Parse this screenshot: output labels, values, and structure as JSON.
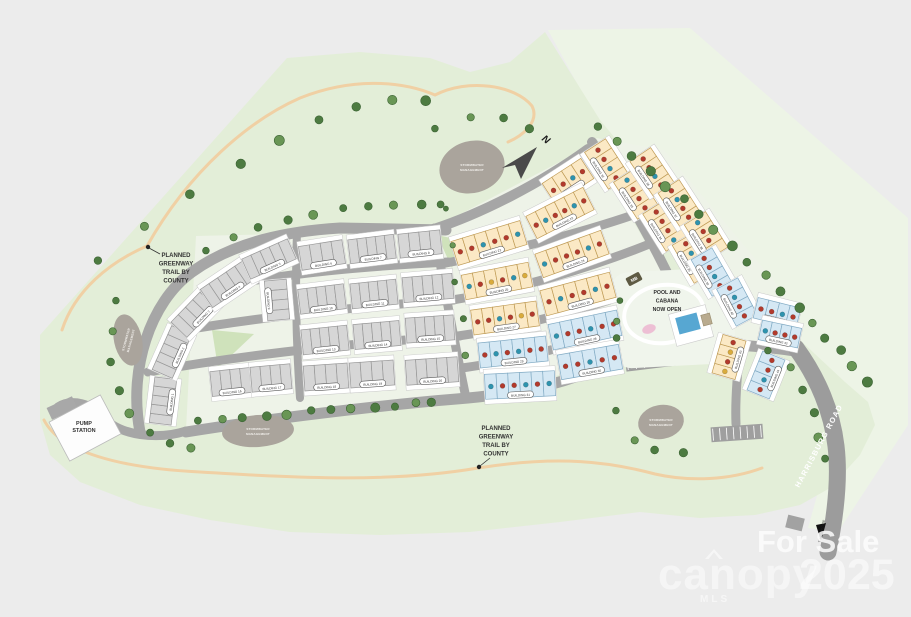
{
  "labels": {
    "greenway_note_lines": [
      "PLANNED",
      "GREENWAY",
      "TRAIL BY",
      "COUNTY"
    ],
    "pump_station_lines": [
      "PUMP",
      "STATION"
    ],
    "pool_lines": [
      "POOL AND",
      "CABANA",
      "NOW OPEN"
    ],
    "stormwater_lines": [
      "STORMWATER",
      "MANAGEMENT"
    ],
    "harrisburg_road": "HARRISBURG ROAD",
    "to_arrow": "TO CHARLOTTE",
    "mailbox": "MB",
    "north": "N",
    "building_prefix": "BUILDING"
  },
  "watermark": {
    "line1": "For Sale",
    "brand": "canopy",
    "brand_sub": "MLS",
    "year": "2025"
  },
  "scene": {
    "palette": {
      "bg": "#ececec",
      "site": "#e3eed8",
      "pale": "#edf4e6",
      "pad": "#eef3e8",
      "park": "#cfe2bb",
      "road": "#a6a6a6",
      "harris": "#9c9c9c",
      "trail": "#f0d0a4",
      "tree": "#4d7b41",
      "tree2": "#699655",
      "treeStroke": "#3c6334",
      "pond": "#aaa49c",
      "pondText": "#f4f2ee",
      "padStroke": "#c9c9c9",
      "gFill": "#d6d6d6",
      "gStroke": "#979797",
      "cFill": "#fbe9c5",
      "cStroke": "#bf9b55",
      "bFill": "#d5e8f4",
      "bStroke": "#82abc4",
      "dotR": "#b23a2c",
      "dotT": "#2e93ae",
      "dotY": "#d9ab3c",
      "ink": "#333333",
      "pillStroke": "#5a5a5a",
      "arrow": "#4a4a4a"
    },
    "greens": [
      {
        "d": "M548,30 L690,28 L908,218 L908,425 L838,532 L808,528 L845,395 L800,342 L700,236 L598,122 Z",
        "f": "#edf4e6"
      },
      {
        "d": "M287,58 L360,52 L430,58 L470,72 L510,62 L545,32 L600,120 L650,180 L700,235 L750,290 L800,340 L845,382 L868,402 L875,425 L860,455 L830,488 L800,505 L755,515 L700,518 L640,512 L560,522 L470,532 L380,535 L290,532 L210,520 L140,505 L80,482 L50,455 L40,420 L40,335 Z",
        "f": "#e3eed8"
      },
      {
        "d": "M196,236 L448,230 L468,400 L186,430 Z",
        "f": "#eef3e8"
      },
      {
        "d": "M434,228 L590,146 L690,320 L620,360 L466,398 Z",
        "f": "#eef3e8"
      },
      {
        "d": "M596,138 L664,150 L790,300 L800,350 L735,340 Z",
        "f": "#eef3e8"
      },
      {
        "d": "M212,330 L254,334 L218,368 Z",
        "f": "#cfe2bb"
      },
      {
        "d": "M437,235 L460,240 L452,268 Z",
        "f": "#cfe2bb"
      }
    ],
    "trails": [
      "M62,330 C75,290 110,262 147,246 C190,170 250,120 300,98 C350,78 400,80 435,95 C468,78 515,85 532,106 C540,122 522,136 508,142",
      "M44,420 C60,452 120,468 200,472 C300,478 390,483 478,468 C560,455 610,462 655,474 C690,482 730,480 762,468"
    ],
    "roads": [
      {
        "d": "M140,432 C128,370 150,302 192,272 C235,241 290,231 340,228 L446,230",
        "w": 11
      },
      {
        "d": "M186,432 C260,420 380,405 468,398 C530,392 570,382 612,362",
        "w": 11
      },
      {
        "d": "M434,229 C480,214 540,184 588,149",
        "w": 10
      },
      {
        "d": "M592,142 C630,200 662,258 688,318",
        "w": 10
      },
      {
        "d": "M446,263 C505,252 575,235 636,214",
        "w": 9
      },
      {
        "d": "M452,300 C515,290 590,268 652,243",
        "w": 9
      },
      {
        "d": "M458,336 C515,328 575,312 640,290",
        "w": 9
      },
      {
        "d": "M462,368 C520,360 575,345 622,326",
        "w": 9
      },
      {
        "d": "M434,228 C444,286 454,340 466,398",
        "w": 9
      },
      {
        "d": "M297,232 C295,290 296,340 300,398",
        "w": 8
      },
      {
        "d": "M201,290 C290,272 370,266 448,262",
        "w": 9
      },
      {
        "d": "M179,331 C280,314 380,305 454,300",
        "w": 9
      },
      {
        "d": "M148,372 C260,352 380,341 460,336",
        "w": 9
      },
      {
        "d": "M612,362 C648,352 686,344 722,344 C756,346 778,348 800,352",
        "w": 11
      },
      {
        "d": "M688,318 C696,332 706,340 718,344",
        "w": 10
      },
      {
        "d": "M635,290 C626,312 621,334 620,356",
        "w": 9
      },
      {
        "d": "M740,350 C737,376 735,400 736,424",
        "w": 9
      },
      {
        "d": "M186,431 C158,440 120,436 103,417 C92,404 72,398 58,407",
        "w": 9
      },
      {
        "d": "M796,348 C818,378 832,412 836,446 C840,480 835,518 828,552",
        "w": 17,
        "c": "#9c9c9c"
      }
    ],
    "parking": [
      {
        "x": 664,
        "y": 357,
        "w": 78,
        "h": 20,
        "a": -7,
        "n": 9
      },
      {
        "x": 737,
        "y": 433,
        "w": 52,
        "h": 15,
        "a": -4,
        "n": 7
      }
    ],
    "ponds": [
      {
        "x": 472,
        "y": 167,
        "rx": 33,
        "ry": 26,
        "a": -15,
        "tr": 0
      },
      {
        "x": 128,
        "y": 340,
        "rx": 14,
        "ry": 26,
        "a": -12,
        "tr": -75
      },
      {
        "x": 258,
        "y": 431,
        "rx": 36,
        "ry": 16,
        "a": -4,
        "tr": 0
      },
      {
        "x": 661,
        "y": 422,
        "rx": 23,
        "ry": 17,
        "a": -10,
        "tr": 0
      }
    ],
    "tree_strips": [
      {
        "p": [
          [
            100,
            262
          ],
          [
            150,
            222
          ],
          [
            205,
            185
          ],
          [
            260,
            150
          ],
          [
            300,
            128
          ],
          [
            345,
            110
          ],
          [
            390,
            100
          ],
          [
            425,
            100
          ]
        ],
        "n": 9,
        "r": 4.5
      },
      {
        "p": [
          [
            437,
            130
          ],
          [
            470,
            118
          ],
          [
            505,
            118
          ],
          [
            528,
            128
          ]
        ],
        "n": 4,
        "r": 4
      },
      {
        "p": [
          [
            208,
            252
          ],
          [
            240,
            234
          ],
          [
            275,
            222
          ],
          [
            310,
            214
          ],
          [
            345,
            209
          ],
          [
            380,
            206
          ],
          [
            415,
            204
          ],
          [
            442,
            203
          ]
        ],
        "n": 10,
        "r": 4
      },
      {
        "p": [
          [
            600,
            128
          ],
          [
            640,
            162
          ],
          [
            680,
            198
          ],
          [
            720,
            234
          ],
          [
            760,
            272
          ],
          [
            800,
            310
          ],
          [
            835,
            345
          ],
          [
            866,
            382
          ]
        ],
        "n": 18,
        "r": 4.5
      },
      {
        "p": [
          [
            200,
            422
          ],
          [
            240,
            418
          ],
          [
            280,
            414
          ],
          [
            320,
            411
          ],
          [
            360,
            408
          ],
          [
            400,
            405
          ],
          [
            432,
            403
          ]
        ],
        "n": 12,
        "r": 4.2
      },
      {
        "p": [
          [
            118,
            302
          ],
          [
            112,
            332
          ],
          [
            112,
            362
          ],
          [
            118,
            390
          ],
          [
            130,
            412
          ],
          [
            148,
            434
          ],
          [
            170,
            444
          ],
          [
            193,
            448
          ]
        ],
        "n": 8,
        "r": 4
      },
      {
        "p": [
          [
            770,
            352
          ],
          [
            790,
            368
          ],
          [
            804,
            390
          ],
          [
            813,
            412
          ],
          [
            819,
            436
          ],
          [
            823,
            460
          ]
        ],
        "n": 6,
        "r": 4
      },
      {
        "p": [
          [
            618,
            412
          ],
          [
            634,
            441
          ],
          [
            656,
            450
          ],
          [
            682,
            452
          ]
        ],
        "n": 4,
        "r": 4
      },
      {
        "p": [
          [
            622,
            302
          ],
          [
            616,
            322
          ],
          [
            618,
            338
          ]
        ],
        "n": 3,
        "r": 3.5
      },
      {
        "p": [
          [
            448,
            210
          ],
          [
            452,
            246
          ],
          [
            456,
            282
          ],
          [
            462,
            318
          ],
          [
            466,
            354
          ]
        ],
        "n": 5,
        "r": 3
      }
    ],
    "buildings": [
      [
        163,
        401,
        46,
        22,
        -83,
        "g",
        5,
        ""
      ],
      [
        172,
        352,
        48,
        22,
        -66,
        "g",
        5,
        ""
      ],
      [
        197,
        311,
        52,
        22,
        -46,
        "g",
        5,
        ""
      ],
      [
        228,
        284,
        52,
        22,
        -34,
        "g",
        5,
        ""
      ],
      [
        269,
        259,
        50,
        22,
        -24,
        "g",
        5,
        ""
      ],
      [
        322,
        255,
        44,
        24,
        -9,
        "g",
        4,
        ""
      ],
      [
        372,
        249,
        46,
        24,
        -7,
        "g",
        5,
        ""
      ],
      [
        420,
        244,
        42,
        24,
        -6,
        "g",
        4,
        ""
      ],
      [
        277,
        300,
        40,
        22,
        85,
        "g",
        4,
        ""
      ],
      [
        322,
        299,
        46,
        25,
        -7,
        "g",
        5,
        ""
      ],
      [
        374,
        294,
        46,
        25,
        -6,
        "g",
        5,
        ""
      ],
      [
        428,
        288,
        50,
        25,
        -5,
        "g",
        5,
        ""
      ],
      [
        325,
        340,
        46,
        25,
        -6,
        "g",
        5,
        ""
      ],
      [
        377,
        335,
        46,
        25,
        -5,
        "g",
        5,
        ""
      ],
      [
        430,
        329,
        48,
        25,
        -4,
        "g",
        5,
        ""
      ],
      [
        231,
        382,
        40,
        25,
        -6,
        "g",
        4,
        ""
      ],
      [
        271,
        378,
        40,
        25,
        -5,
        "g",
        4,
        ""
      ],
      [
        326,
        377,
        44,
        25,
        -4,
        "g",
        4,
        ""
      ],
      [
        372,
        374,
        44,
        25,
        -4,
        "g",
        4,
        ""
      ],
      [
        432,
        371,
        52,
        25,
        -4,
        "g",
        5,
        ""
      ],
      [
        568,
        181,
        46,
        24,
        -33,
        "c",
        4,
        "rrtr"
      ],
      [
        560,
        213,
        64,
        25,
        -27,
        "c",
        6,
        "rtrrtr"
      ],
      [
        489,
        243,
        72,
        25,
        -17,
        "c",
        6,
        "rrtrrt"
      ],
      [
        572,
        254,
        70,
        25,
        -20,
        "c",
        6,
        "trrrtr"
      ],
      [
        497,
        281,
        68,
        25,
        -11,
        "c",
        6,
        "tryrty"
      ],
      [
        578,
        294,
        72,
        26,
        -15,
        "c",
        6,
        "rtrrtr"
      ],
      [
        505,
        318,
        66,
        25,
        -8,
        "c",
        6,
        "rrtryr"
      ],
      [
        585,
        330,
        70,
        26,
        -12,
        "b",
        6,
        "trrtrr"
      ],
      [
        513,
        352,
        68,
        25,
        -6,
        "b",
        6,
        "rtrtrr"
      ],
      [
        590,
        362,
        62,
        25,
        -10,
        "b",
        5,
        "rrtrr"
      ],
      [
        520,
        385,
        70,
        25,
        -3,
        "b",
        6,
        "trrtrt"
      ],
      [
        607,
        164,
        44,
        25,
        57,
        "c",
        4,
        "rrtr"
      ],
      [
        636,
        194,
        44,
        25,
        57,
        "c",
        4,
        "trrr"
      ],
      [
        665,
        226,
        44,
        25,
        58,
        "c",
        4,
        "rrrt"
      ],
      [
        694,
        258,
        44,
        25,
        60,
        "c",
        4,
        "rtrr"
      ],
      [
        652,
        172,
        42,
        25,
        56,
        "c",
        4,
        "rrtr"
      ],
      [
        680,
        204,
        42,
        25,
        57,
        "c",
        4,
        "rtrr"
      ],
      [
        706,
        236,
        42,
        25,
        58,
        "c",
        4,
        "trrr"
      ],
      [
        712,
        272,
        42,
        24,
        60,
        "b",
        4,
        "rrtr"
      ],
      [
        737,
        302,
        42,
        24,
        62,
        "b",
        4,
        "rtrr"
      ],
      [
        777,
        313,
        44,
        21,
        14,
        "b",
        4,
        "rrtr"
      ],
      [
        780,
        334,
        40,
        20,
        12,
        "b",
        4,
        "trrr"
      ],
      [
        729,
        357,
        40,
        24,
        -74,
        "c",
        4,
        "yryr"
      ],
      [
        766,
        375,
        42,
        24,
        -68,
        "b",
        4,
        "rtrr"
      ]
    ],
    "pool": {
      "pad": {
        "x": 612,
        "y": 270,
        "w": 122,
        "h": 96,
        "r": 18,
        "a": -3
      },
      "loop": {
        "x": 664,
        "y": 314,
        "rx": 40,
        "ry": 29,
        "a": -8
      },
      "deck": {
        "x": 672,
        "y": 309,
        "w": 38,
        "h": 33,
        "a": -15
      },
      "water": {
        "x": 677,
        "y": 315,
        "w": 22,
        "h": 17,
        "a": -15
      },
      "cabana": {
        "x": 702,
        "y": 314,
        "w": 9,
        "h": 11,
        "a": -15
      },
      "playground": {
        "x": 649,
        "y": 329,
        "rx": 7,
        "ry": 4.5,
        "a": -20
      },
      "text": {
        "x": 667,
        "y": 294,
        "lh": 8.5
      }
    },
    "mailbox": {
      "x": 634,
      "y": 279,
      "w": 15,
      "h": 9,
      "a": -28
    },
    "compass": {
      "poly": "502,168 537,147 521,179 515,165",
      "nx": 544,
      "ny": 142,
      "na": 38
    },
    "pump": {
      "x": 85,
      "y": 428,
      "w": 58,
      "h": 44,
      "a": -28,
      "drx": 62,
      "dry": 408,
      "drw": 28,
      "drh": 13,
      "dra": -25,
      "tx": 84,
      "ty": 425,
      "lh": 7
    },
    "notes": [
      {
        "tx": 176,
        "ty": 257,
        "lh": 8.5,
        "leader": [
          160,
          254,
          149,
          248
        ],
        "dot": [
          148,
          247
        ]
      },
      {
        "tx": 496,
        "ty": 430,
        "lh": 8.5,
        "leader": [
          490,
          458,
          480,
          466
        ],
        "dot": [
          479,
          467
        ]
      }
    ],
    "harrisburg_label": {
      "x": 821,
      "y": 447,
      "a": -62
    },
    "to_arrow": {
      "poly": "816,525 826,523 821,541",
      "tx": 825,
      "ty": 520,
      "ta": -78
    },
    "gray_box": {
      "x": 795,
      "y": 523,
      "w": 17,
      "h": 13,
      "a": 14
    }
  }
}
